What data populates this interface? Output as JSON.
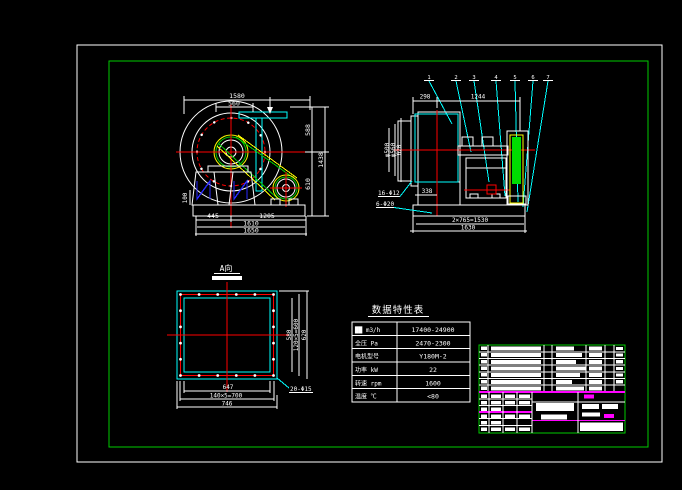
{
  "drawing": {
    "type": "centrifugal-fan CAD drawing",
    "background": "#000000",
    "frame_color": "#ffffff",
    "border_color": "#00cc00",
    "accent_colors": {
      "centerline_red": "#ff0000",
      "duct_cyan": "#00ffff",
      "belt_yellow": "#ffff00",
      "flange_green": "#00dd00",
      "titleblock_magenta": "#ff00ff",
      "leg_hatch_blue": "#2a2aff"
    }
  },
  "front_view": {
    "dims": {
      "top": "1580",
      "outlet": "560",
      "right_upper": "588",
      "right_total": "1438",
      "right_lower": "610",
      "foot": "100",
      "bottom_left": "445",
      "bottom_mid": "1205",
      "bottom_inner": "1610",
      "bottom_total": "1650"
    }
  },
  "side_view": {
    "balloons": [
      "1",
      "2",
      "3",
      "4",
      "5",
      "6",
      "7"
    ],
    "dims": {
      "top_left": "298",
      "top_width": "1244",
      "inlet_inner": "φ500",
      "inlet_bolt": "φ560",
      "inlet_outer": "620",
      "foot": "338",
      "bottom_spacing": "2×765=1530",
      "bottom_total": "1630"
    },
    "callouts": {
      "inlet_holes": "16-Φ12",
      "base_holes": "6-Φ20"
    }
  },
  "a_view": {
    "label": "A向",
    "dims": {
      "width_inner": "647",
      "width_bolt": "140×5=700",
      "width_outer": "746",
      "height_inner": "580",
      "height_bolt": "120×5=600",
      "height_outer": "620"
    },
    "callouts": {
      "flange_holes": "20-Φ15"
    }
  },
  "spec_table": {
    "title": "数据特性表",
    "rows": [
      {
        "label": "██ m3/h",
        "value": "17400-24900"
      },
      {
        "label": "全压 Pa",
        "value": "2470-2300"
      },
      {
        "label": "电机型号",
        "value": "Y180M-2"
      },
      {
        "label": "功率 kW",
        "value": "22"
      },
      {
        "label": "转速 rpm",
        "value": "1600"
      },
      {
        "label": "温度 ℃",
        "value": "<80"
      }
    ]
  }
}
